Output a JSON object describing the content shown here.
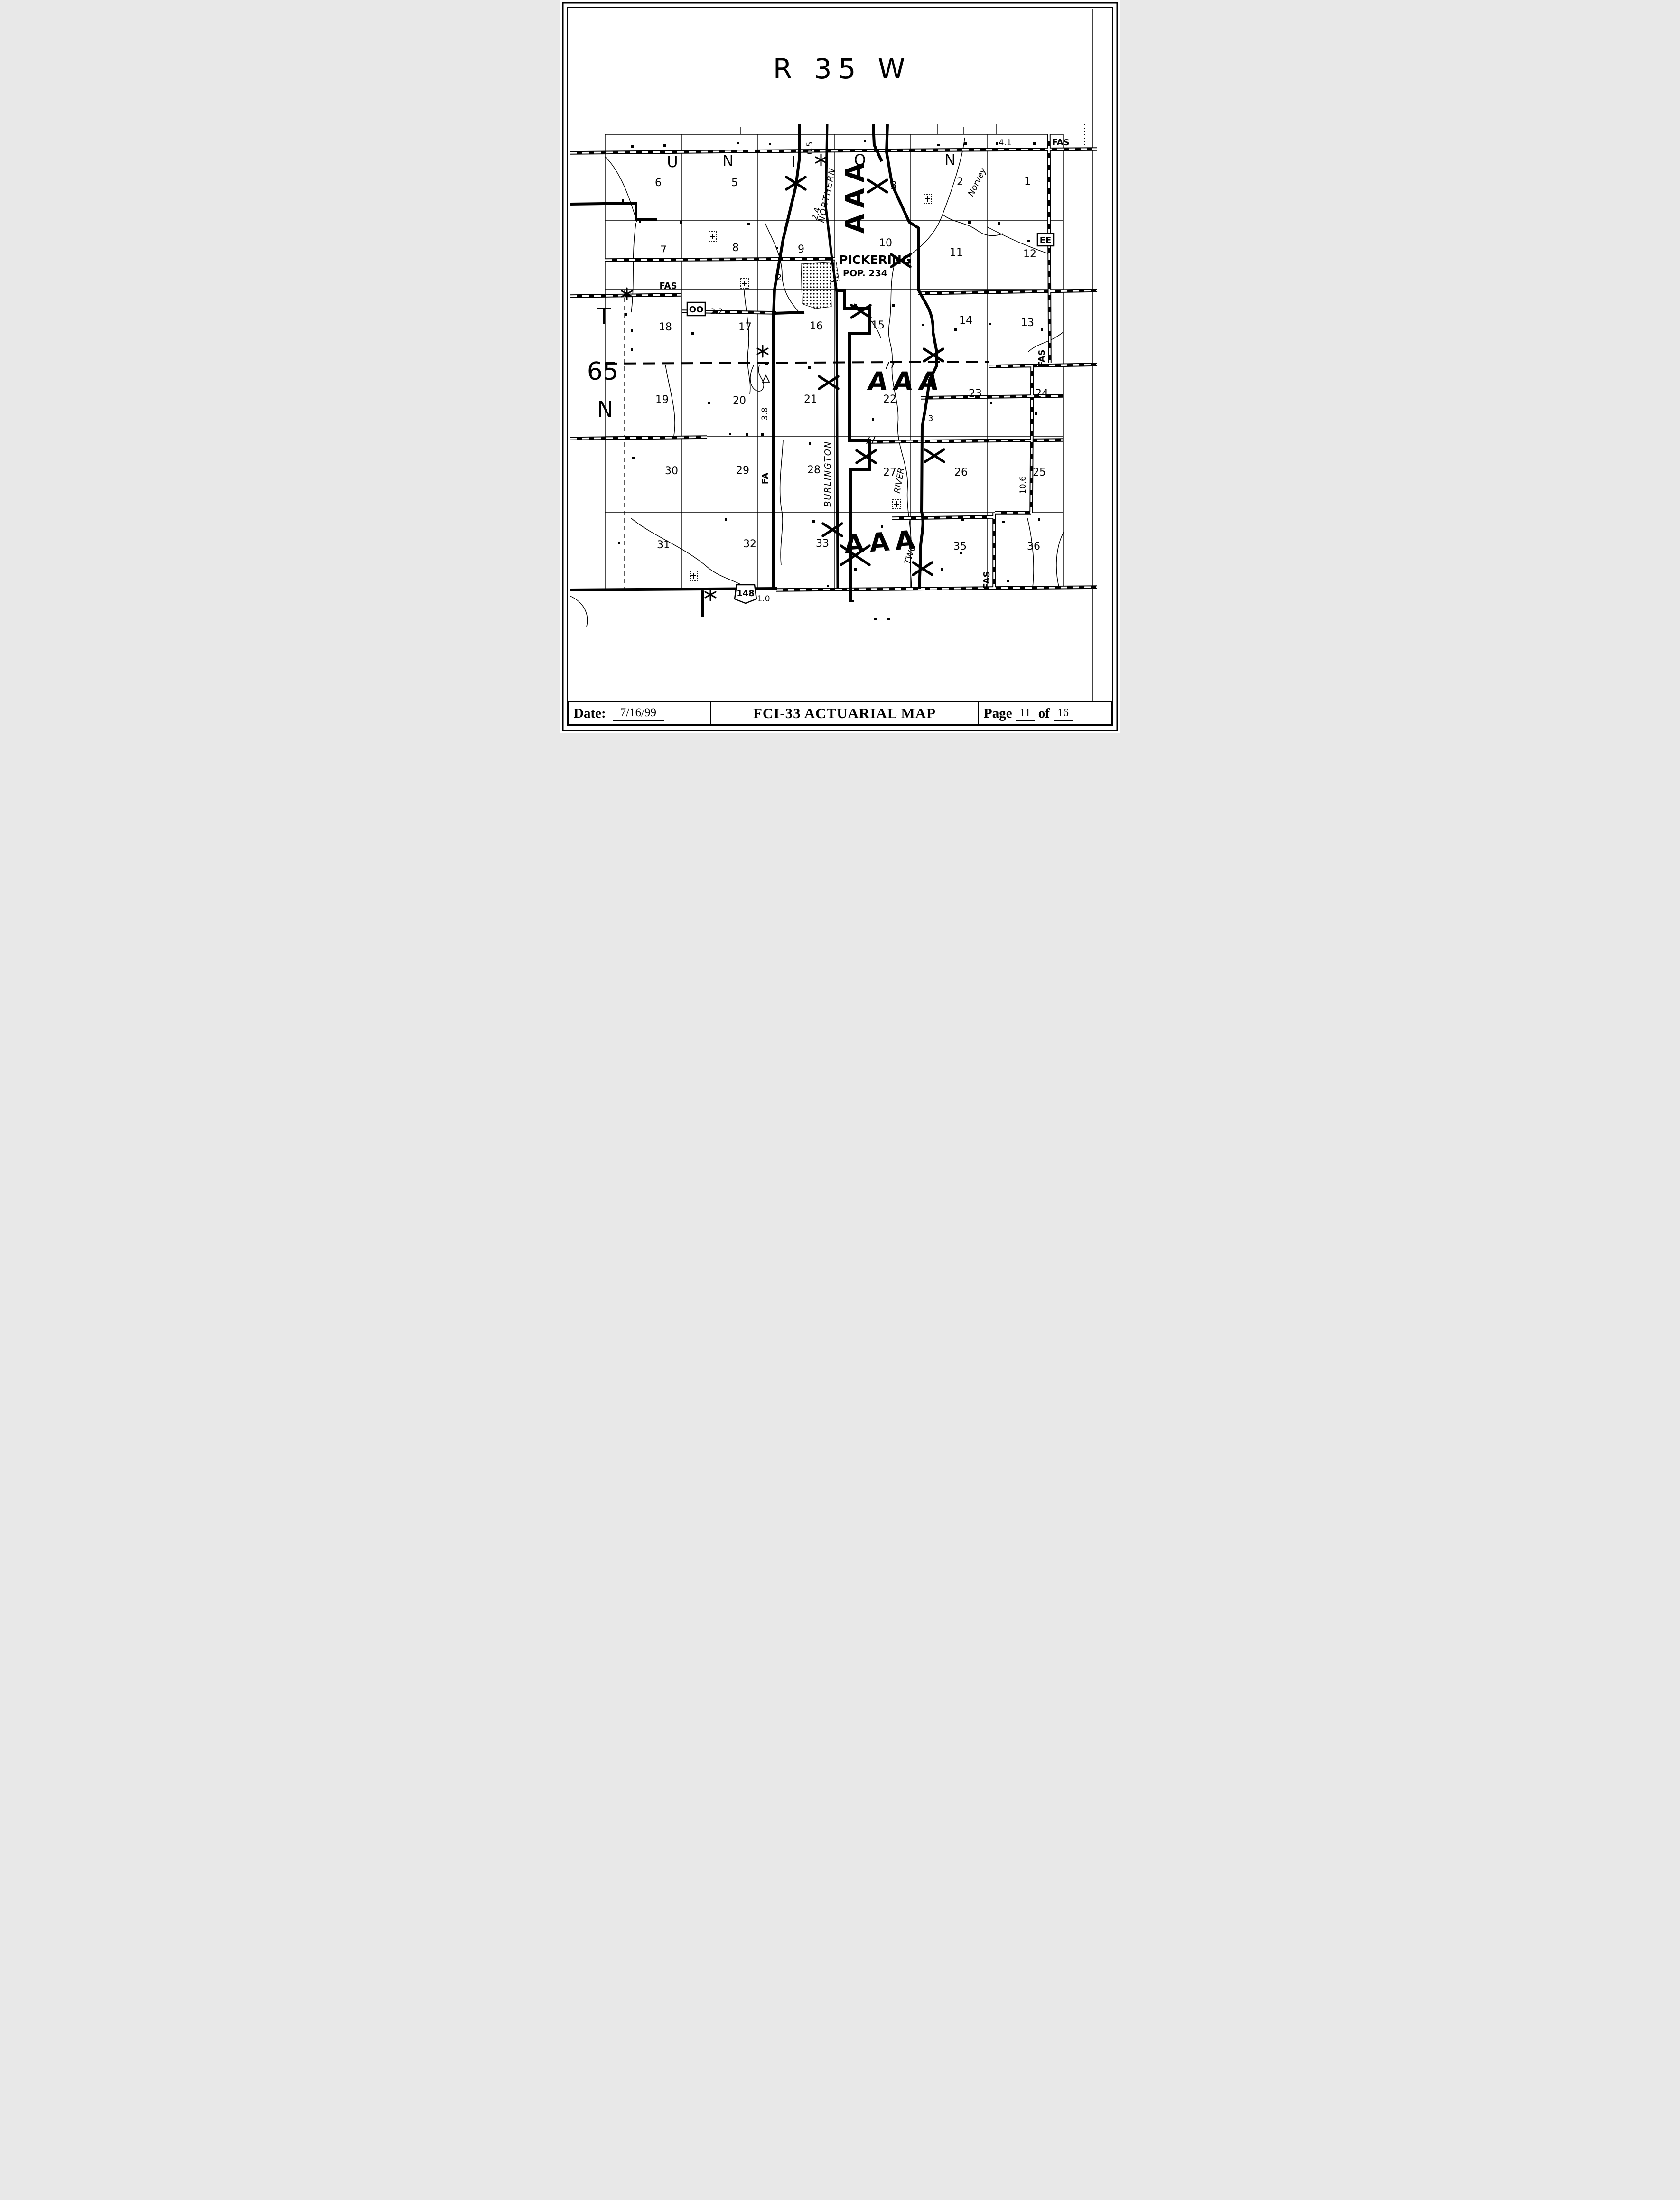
{
  "header": {
    "range_label": "R 35 W"
  },
  "margin": {
    "t": "T",
    "n65": "65",
    "n": "N"
  },
  "map": {
    "union_letters": [
      "U",
      "N",
      "I",
      "O",
      "N"
    ],
    "section_numbers": [
      "6",
      "5",
      "3",
      "2",
      "1",
      "7",
      "8",
      "9",
      "10",
      "11",
      "12",
      "18",
      "17",
      "16",
      "15",
      "14",
      "13",
      "19",
      "20",
      "21",
      "22",
      "23",
      "24",
      "30",
      "29",
      "28",
      "27",
      "26",
      "25",
      "31",
      "32",
      "33",
      "35",
      "36"
    ],
    "town": {
      "name": "PICKERING",
      "pop": "POP. 234"
    },
    "zones": [
      "AAA",
      "AAA",
      "AAA"
    ],
    "railroad": {
      "upper": "NORTHERN",
      "lower": "BURLINGTON"
    },
    "streams": {
      "norvey": "Norvey",
      "two": "TWO",
      "river": "RIVER"
    },
    "roads": {
      "fas_top": "FAS",
      "fas_left": "FAS",
      "fas_right": "FAS",
      "fas_bottom": "FAS",
      "fa": "FA",
      "oo": "OO",
      "ee": "EE",
      "hwy148": "148"
    },
    "miles": {
      "a": "0.5",
      "b": "2.4",
      "c": "4.1",
      "d": "2.2",
      "e": "2",
      "f": "3.8",
      "g": "3",
      "h": "10.6",
      "i": "1.0"
    }
  },
  "footer": {
    "date_label": "Date:",
    "date_value": "7/16/99",
    "title": "FCI-33 ACTUARIAL MAP",
    "page_label": "Page",
    "page_value": "11",
    "of_label": "of",
    "total_value": "16"
  },
  "colors": {
    "ink": "#000000",
    "paper": "#ffffff"
  }
}
